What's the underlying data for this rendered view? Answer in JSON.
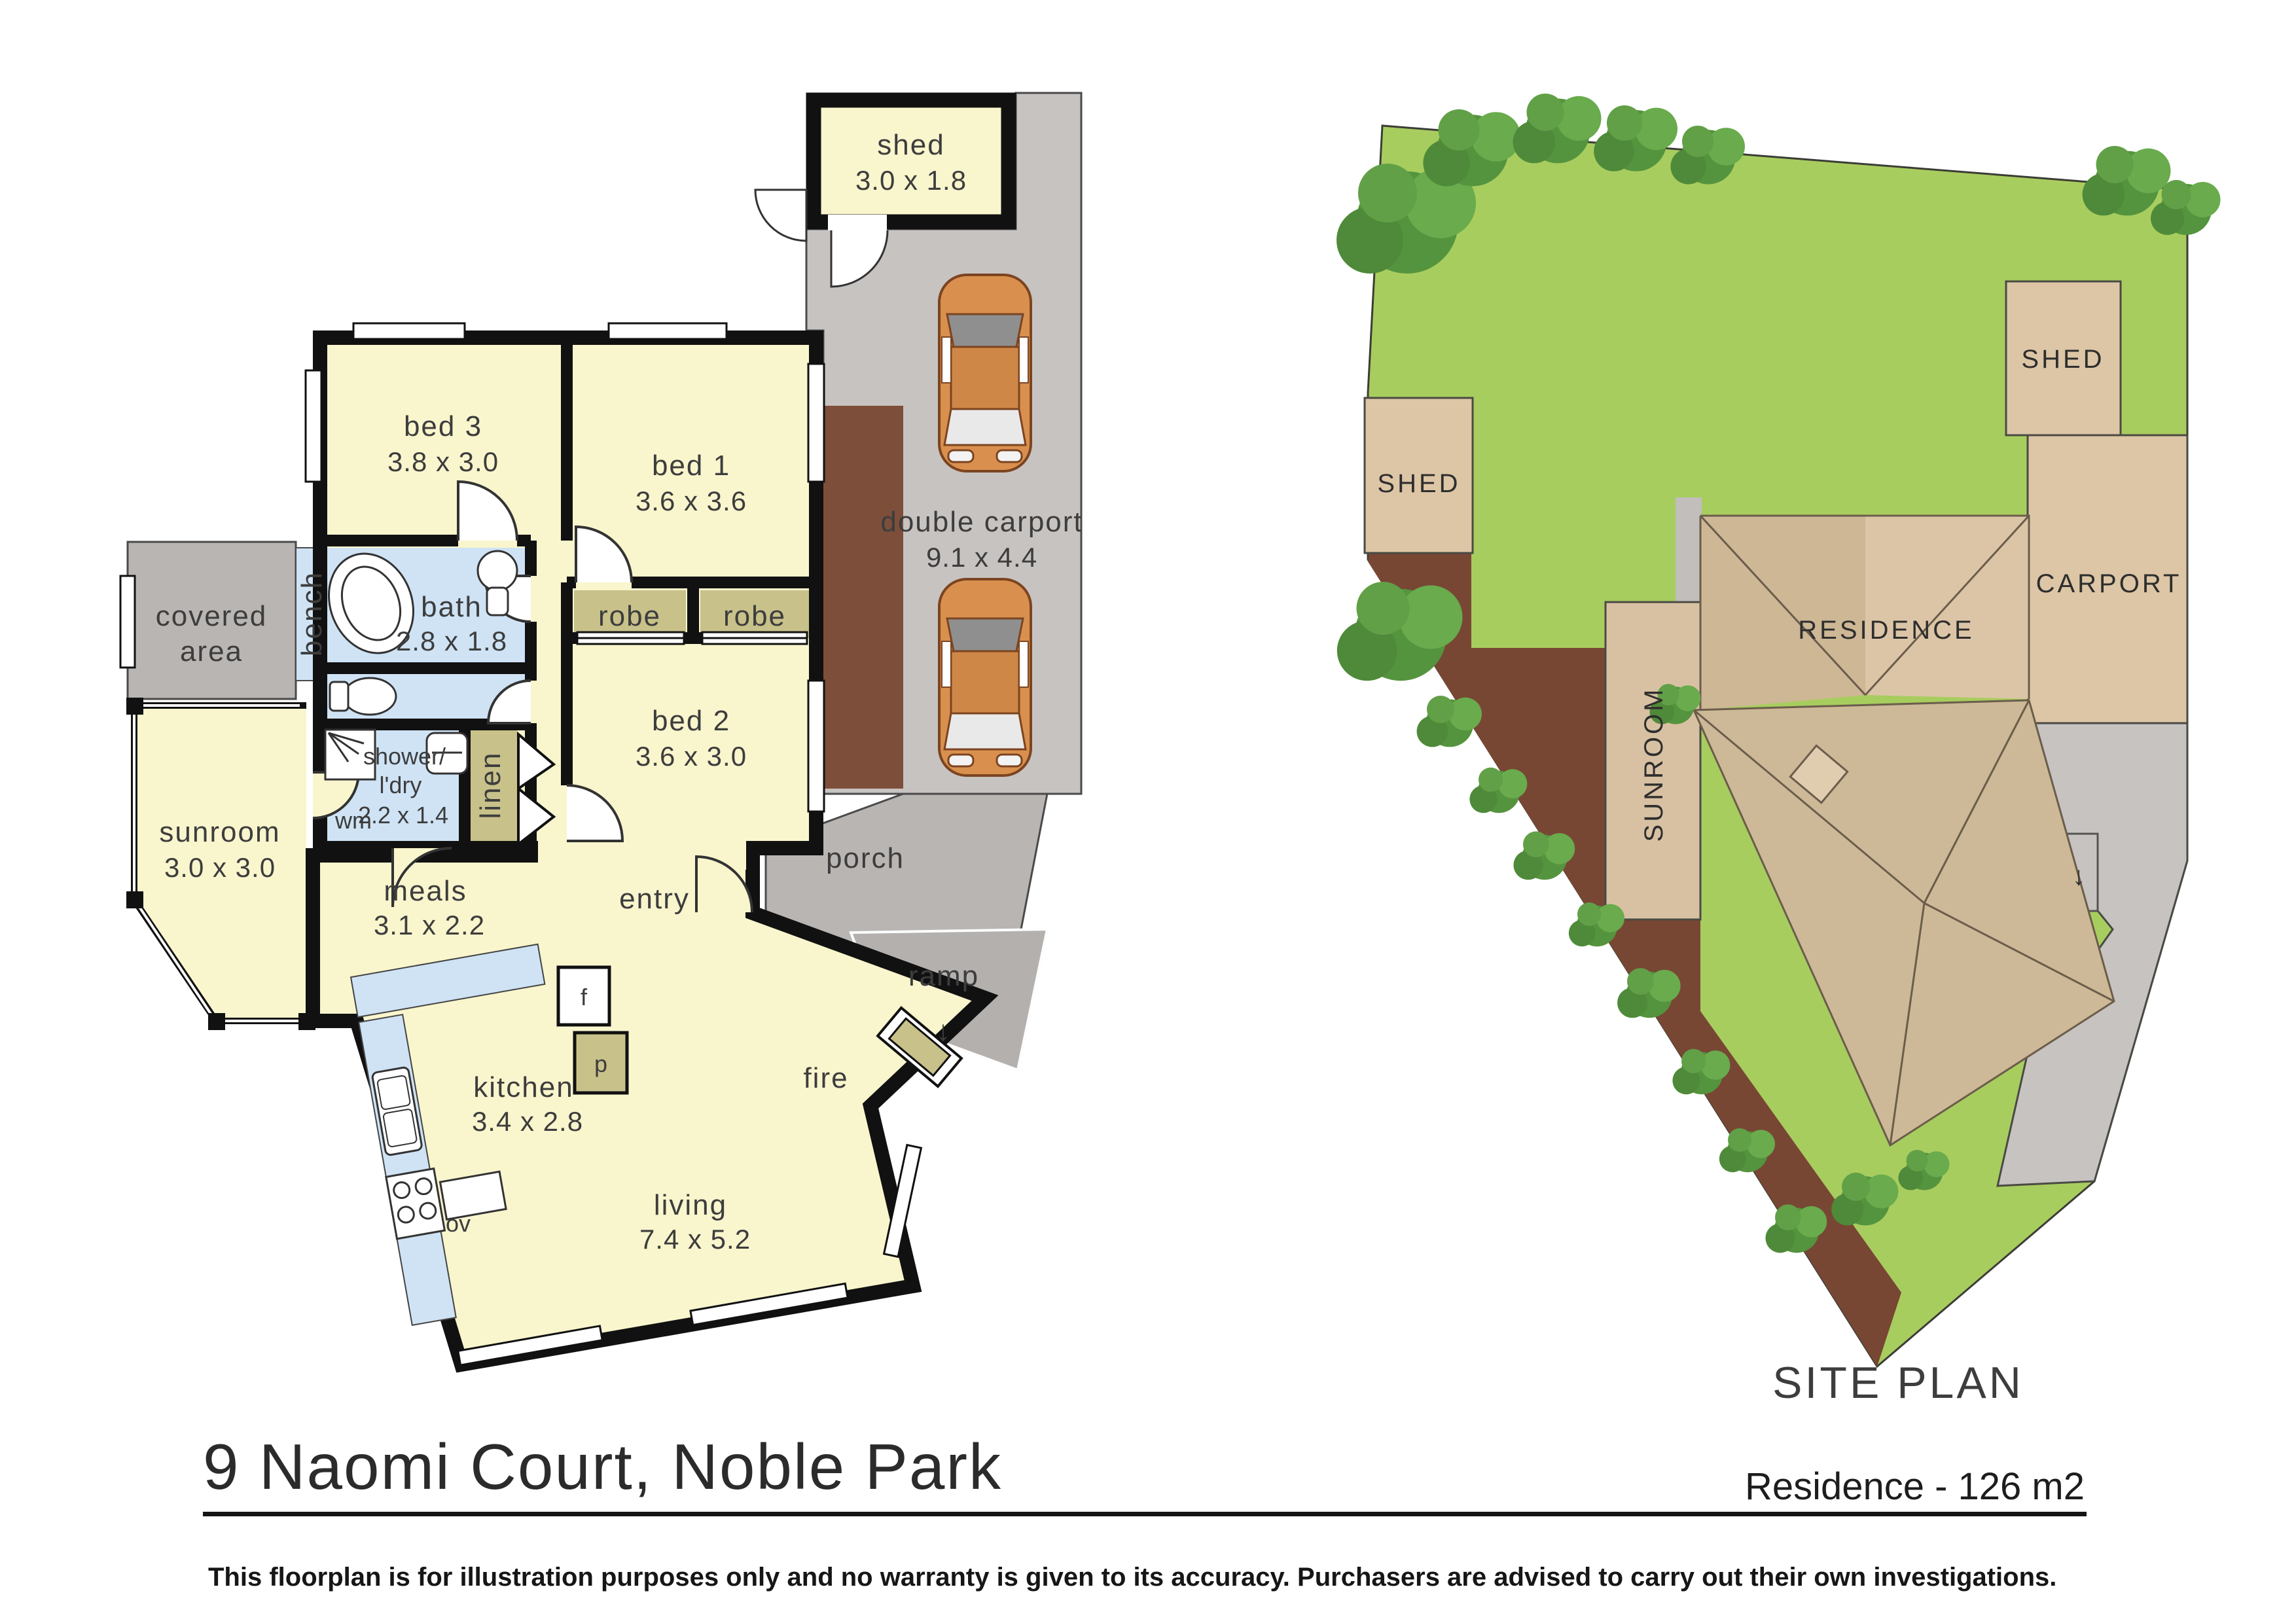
{
  "page": {
    "title": "9 Naomi Court, Noble Park",
    "area_note": "Residence - 126 m2",
    "disclaimer": "This floorplan is for illustration purposes only and no warranty is given to its accuracy. Purchasers are advised to carry out their own investigations."
  },
  "floorplan": {
    "shed": {
      "name": "shed",
      "dims": "3.0 x 1.8"
    },
    "carport": {
      "name": "double carport",
      "dims": "9.1 x 4.4"
    },
    "bed3": {
      "name": "bed 3",
      "dims": "3.8 x 3.0"
    },
    "bed1": {
      "name": "bed 1",
      "dims": "3.6 x 3.6"
    },
    "bed2": {
      "name": "bed 2",
      "dims": "3.6 x 3.0"
    },
    "bath": {
      "name": "bath",
      "dims": "2.8 x 1.8"
    },
    "laundry": {
      "line1": "shower/",
      "line2": "l'dry",
      "dims": "2.2 x 1.4"
    },
    "sunroom": {
      "name": "sunroom",
      "dims": "3.0 x 3.0"
    },
    "meals": {
      "name": "meals",
      "dims": "3.1 x 2.2"
    },
    "kitchen": {
      "name": "kitchen",
      "dims": "3.4 x 2.8"
    },
    "living": {
      "name": "living",
      "dims": "7.4 x 5.2"
    },
    "covered_line1": "covered",
    "covered_line2": "area",
    "bench": "bench",
    "robe_left": "robe",
    "robe_right": "robe",
    "linen": "linen",
    "wm": "wm",
    "entry": "entry",
    "porch": "porch",
    "ramp": "ramp",
    "ramp_arrow": "↓",
    "fire": "fire",
    "fridge": "f",
    "pantry": "p",
    "oven": "ov"
  },
  "site_plan": {
    "title": "SITE PLAN",
    "shed_left": "SHED",
    "shed_right": "SHED",
    "carport": "CARPORT",
    "residence": "RESIDENCE",
    "sunroom": "SUNROOM",
    "drive_arrow": "↓"
  },
  "colors": {
    "room_yellow": "#f9f5cd",
    "wet_blue": "#cfe3f5",
    "robe_olive": "#c8c18a",
    "area_gray": "#b9b5b2",
    "carport_gray": "#c7c3c1",
    "garden_brown": "#7d4f3a",
    "wall_black": "#111111",
    "lawn_green": "#a8cd5f",
    "tan_light": "#ddc6a6",
    "tan_mid": "#d2bb99",
    "tan_dark": "#c9b392",
    "tree_green": "#55943e",
    "car_orange": "#d9904f"
  }
}
